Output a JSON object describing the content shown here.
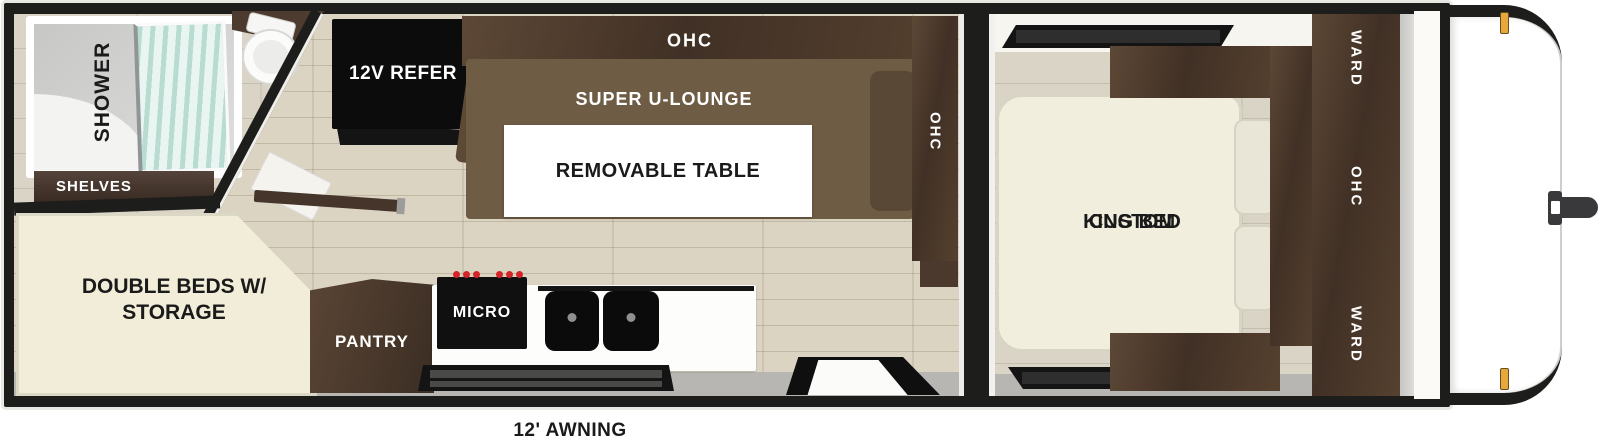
{
  "labels": {
    "shower": "SHOWER",
    "shelves": "SHELVES",
    "double_beds_line1": "DOUBLE BEDS W/",
    "double_beds_line2": "STORAGE",
    "refer": "12V REFER",
    "ohc_top": "OHC",
    "lounge": "SUPER U-LOUNGE",
    "table": "REMOVABLE TABLE",
    "ohc_galley": "OHC",
    "pantry": "PANTRY",
    "micro": "MICRO",
    "bed_line1": "CUSTOM",
    "bed_line2": "KING BED",
    "ward_top": "WARD",
    "ohc_bedroom": "OHC",
    "ward_bottom": "WARD",
    "awning": "12' AWNING"
  },
  "colors": {
    "wall_black": "#1d1d1b",
    "wood_floor": "#dbd4c2",
    "tile_floor": "#d9d4c5",
    "cabinet_brown": "#4a392c",
    "lounge_brown": "#6f5c45",
    "bed_cream": "#f2eedd",
    "burner_knob_red": "#d3242a",
    "marker_light_amber": "#e6a83c",
    "glass_aqua": "#b9dcd2"
  }
}
